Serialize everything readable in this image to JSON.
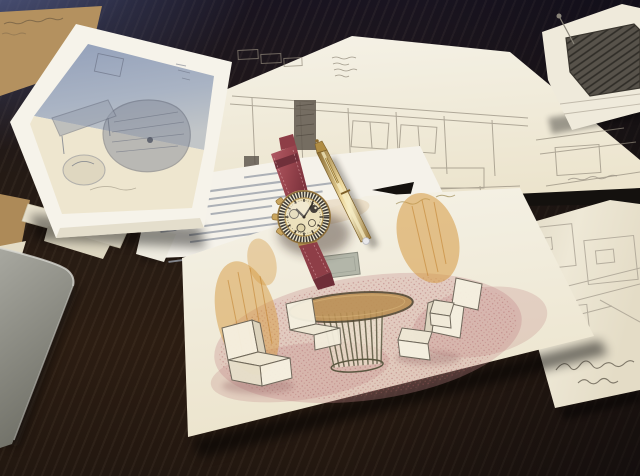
{
  "scene": {
    "description": "Photograph: hand-drawn interior design sketches spread on a dark wooden table, with a gold chronograph wristwatch on a maroon leather strap and a gold pen lying on top",
    "surface": {
      "name": "dark-wood-table",
      "tint_top_left": "blue-gray daylight reflection"
    },
    "papers": [
      {
        "name": "photo-sheet-blue-sketch",
        "detail": "top-left sheet, blue-toned print of a furniture sketch with wide cream margins",
        "text": "illegible pencil marks"
      },
      {
        "name": "kraft-envelope",
        "detail": "tan kraft paper peeking out top-left",
        "text": "illegible handwriting"
      },
      {
        "name": "wide-elevation-sketch",
        "detail": "center sheet, pencil wall elevation with windows, benches and a dark doorway",
        "text": "illegible annotation block"
      },
      {
        "name": "top-right-sketch",
        "detail": "sheet with dark hatched furniture shape",
        "text": "none"
      },
      {
        "name": "typed-letter",
        "detail": "typewritten letter under the watch and pen",
        "text": "illegible typescript lines"
      },
      {
        "name": "right-panel-sketch",
        "detail": "right sheet with panel rectangles and a cursive signature",
        "text": "illegible signature"
      },
      {
        "name": "colored-presentation-sketch",
        "detail": "bottom sheet, colored-pencil rendering: round slatted pedestal table, white cube chairs, pink stippled carpet, golden-yellow curtains, gray wall frame",
        "text": "illegible caption"
      }
    ],
    "objects": {
      "watch": {
        "case": "gold chronograph",
        "bezel": "black/white speckled scale",
        "dial": "cream with dark sub-dials",
        "strap": "maroon leather"
      },
      "pen": {
        "body": "gold",
        "end_cap": "white dot"
      },
      "gray-object": {
        "detail": "corner of a gray chair/ledge at bottom-left"
      }
    }
  },
  "palette": {
    "table-blue": "#5a6690",
    "table-dark": "#191420",
    "table-brown": "#2c1d12",
    "table-brown-deep": "#221710",
    "paper-bright": "#f5f2e7",
    "paper-cream": "#ece4cd",
    "paper-shade": "#d9d1bb",
    "kraft": "#b4915f",
    "gray-object-light": "#a8a8a0",
    "gray-object-dark": "#6f6f66",
    "sketch-stroke": "#948c7d",
    "strap-red": "#9c4750",
    "strap-red-deep": "#7c333d",
    "gold-light": "#f0dda2",
    "gold": "#c9a15c",
    "gold-deep": "#8a6a30",
    "dial-cream": "#ece1bd",
    "orange-scribble": "#d6993f",
    "pink-carpet": "#c5888b",
    "olive-slats": "#5b5740",
    "table-top-wood": "#bb9055"
  }
}
